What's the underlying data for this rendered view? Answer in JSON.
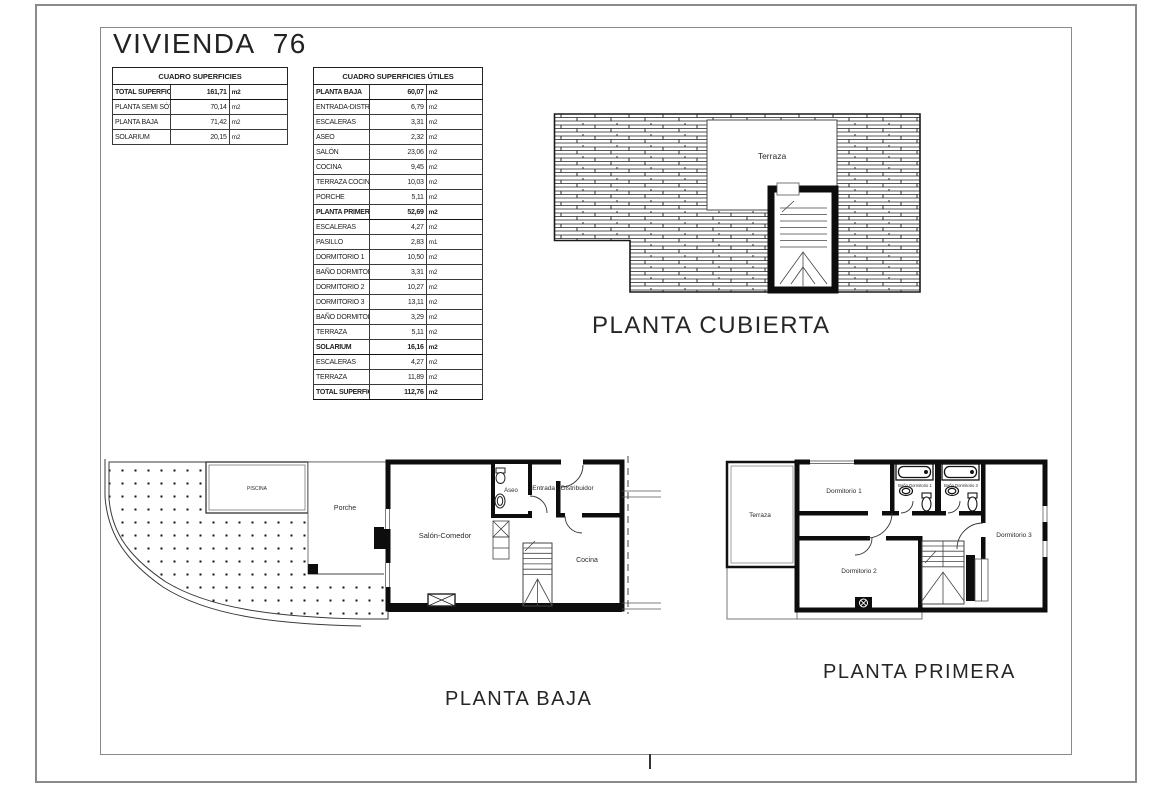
{
  "page": {
    "title": "VIVIENDA  76"
  },
  "tables": {
    "superficies": {
      "header": "CUADRO SUPERFICIES",
      "rows": [
        {
          "label": "TOTAL SUPERFICIE CONSTRUIDA",
          "value": "161,71",
          "unit": "m2",
          "bold": true
        },
        {
          "label": "PLANTA SEMI SÓTANO",
          "value": "70,14",
          "unit": "m2"
        },
        {
          "label": "PLANTA BAJA",
          "value": "71,42",
          "unit": "m2"
        },
        {
          "label": "SOLARIUM",
          "value": "20,15",
          "unit": "m2"
        }
      ]
    },
    "superficies_utiles": {
      "header": "CUADRO SUPERFICIES ÚTILES",
      "rows": [
        {
          "label": "PLANTA BAJA",
          "value": "60,07",
          "unit": "m2",
          "bold": true
        },
        {
          "label": "ENTRADA-DISTRIBUIDOR",
          "value": "6,79",
          "unit": "m2"
        },
        {
          "label": "ESCALERAS",
          "value": "3,31",
          "unit": "m2"
        },
        {
          "label": "ASEO",
          "value": "2,32",
          "unit": "m2"
        },
        {
          "label": "SALÓN",
          "value": "23,06",
          "unit": "m2"
        },
        {
          "label": "COCINA",
          "value": "9,45",
          "unit": "m2"
        },
        {
          "label": "TERRAZA COCINA",
          "value": "10,03",
          "unit": "m2"
        },
        {
          "label": "PORCHE",
          "value": "5,11",
          "unit": "m2"
        },
        {
          "label": "PLANTA PRIMERA",
          "value": "52,69",
          "unit": "m2",
          "bold": true
        },
        {
          "label": "ESCALERAS",
          "value": "4,27",
          "unit": "m2"
        },
        {
          "label": "PASILLO",
          "value": "2,83",
          "unit": "m1"
        },
        {
          "label": "DORMITORIO 1",
          "value": "10,50",
          "unit": "m2"
        },
        {
          "label": "BAÑO DORMITORIO 1",
          "value": "3,31",
          "unit": "m2"
        },
        {
          "label": "DORMITORIO 2",
          "value": "10,27",
          "unit": "m2"
        },
        {
          "label": "DORMITORIO 3",
          "value": "13,11",
          "unit": "m2"
        },
        {
          "label": "BAÑO DORMITORIO 3",
          "value": "3,29",
          "unit": "m2"
        },
        {
          "label": "TERRAZA",
          "value": "5,11",
          "unit": "m2"
        },
        {
          "label": "SOLARIUM",
          "value": "16,16",
          "unit": "m2",
          "bold": true
        },
        {
          "label": "ESCALERAS",
          "value": "4,27",
          "unit": "m2"
        },
        {
          "label": "TERRAZA",
          "value": "11,89",
          "unit": "m2"
        },
        {
          "label": "TOTAL SUPERFICIE ÚTIL",
          "value": "112,76",
          "unit": "m2",
          "bold": true
        }
      ]
    }
  },
  "plans": {
    "cubierta": {
      "title": "PLANTA CUBIERTA",
      "rooms": {
        "terraza": "Terraza"
      }
    },
    "baja": {
      "title": "PLANTA BAJA",
      "rooms": {
        "piscina": "PISCINA",
        "porche": "Porche",
        "salon": "Salón-Comedor",
        "aseo": "Aseo",
        "entrada": "Entrada - Distribuidor",
        "cocina": "Cocina"
      }
    },
    "primera": {
      "title": "PLANTA PRIMERA",
      "rooms": {
        "terraza": "Terraza",
        "dorm1": "Dormitorio 1",
        "bano1": "Baño Dormitorio 1",
        "bano3": "Baño Dormitorio 3",
        "dorm3": "Dormitorio 3",
        "dorm2": "Dormitorio 2"
      }
    }
  },
  "colors": {
    "ink": "#1f1f1f",
    "wall": "#111111",
    "frame": "#8a8a8a"
  }
}
